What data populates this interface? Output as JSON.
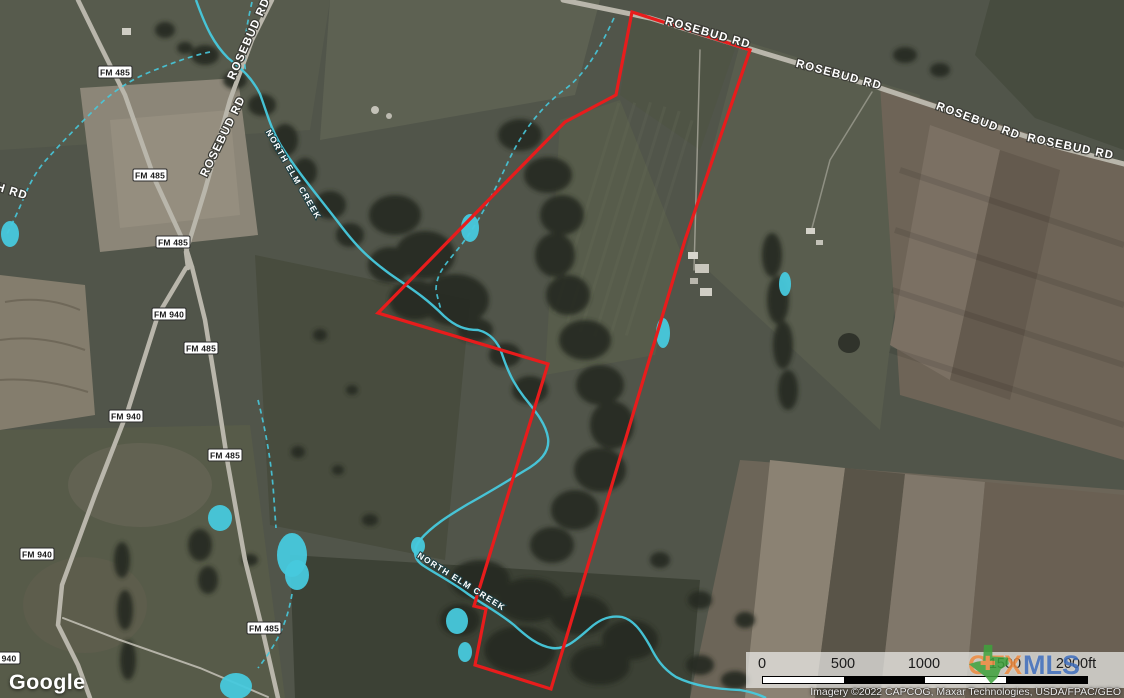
{
  "colors": {
    "boundary_red": "#e81c1c",
    "water_cyan": "#47c9dd",
    "ctx_orange": "#ef8b3f",
    "mls_blue": "#3f6fbe",
    "texas_green": "#3fa23c",
    "shield_bg": "#ffffff",
    "shield_text": "#1a1a1a",
    "label_white": "#ffffff"
  },
  "map": {
    "rosebud_labels": [
      "ROSEBUD RD",
      "ROSEBUD RD",
      "ROSEBUD RD",
      "ROSEBUD RD",
      "ROSEBUD RD",
      "ROSEBUD RD"
    ],
    "partial_road_label": "NCH RD",
    "creek_label": "NORTH ELM CREEK",
    "shields": [
      "FM 485",
      "FM 485",
      "FM 485",
      "FM 940",
      "FM 485",
      "FM 940",
      "FM 485",
      "FM 940",
      "FM 485",
      "940"
    ]
  },
  "branding": {
    "google": "Google",
    "ctx": "CTX",
    "mls": "MLS"
  },
  "scale_bar": {
    "ticks": [
      "0",
      "500",
      "1000",
      "1500"
    ],
    "end_label": "2000ft"
  },
  "attribution": "Imagery ©2022 CAPCOG, Maxar Technologies, USDA/FPAC/GEO"
}
